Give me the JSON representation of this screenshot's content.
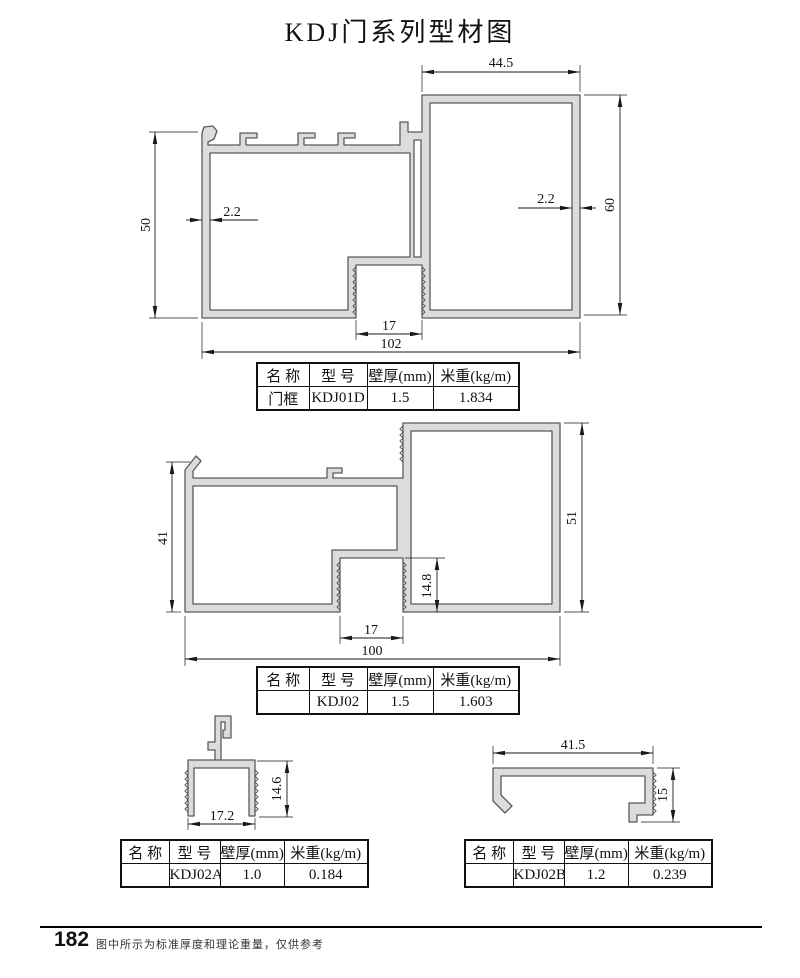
{
  "title": "KDJ门系列型材图",
  "footer": {
    "page": "182",
    "note": "图中所示为标准厚度和理论重量，仅供参考"
  },
  "table_header": {
    "name": "名 称",
    "model": "型 号",
    "thickness": "壁厚(mm)",
    "weight": "米重(kg/m)"
  },
  "profiles": {
    "p1": {
      "label": {
        "name": "门框",
        "model": "KDJ01D",
        "thickness": "1.5",
        "weight": "1.834"
      },
      "dims": {
        "top_width": "44.5",
        "height_right": "60",
        "height_left": "50",
        "wall_left": "2.2",
        "wall_right": "2.2",
        "slot_width": "17",
        "total_width": "102"
      }
    },
    "p2": {
      "label": {
        "name": "",
        "model": "KDJ02",
        "thickness": "1.5",
        "weight": "1.603"
      },
      "dims": {
        "height_left": "41",
        "height_right": "51",
        "slot_depth": "14.8",
        "slot_width": "17",
        "total_width": "100"
      }
    },
    "p3": {
      "label": {
        "name": "",
        "model": "KDJ02A",
        "thickness": "1.0",
        "weight": "0.184"
      },
      "dims": {
        "width": "17.2",
        "height": "14.6"
      }
    },
    "p4": {
      "label": {
        "name": "",
        "model": "KDJ02B",
        "thickness": "1.2",
        "weight": "0.239"
      },
      "dims": {
        "width": "41.5",
        "height": "15"
      }
    }
  },
  "colors": {
    "profile_fill": "#dcdcdc",
    "profile_stroke": "#5a5a5a",
    "dim_color": "#1a1a1a"
  }
}
